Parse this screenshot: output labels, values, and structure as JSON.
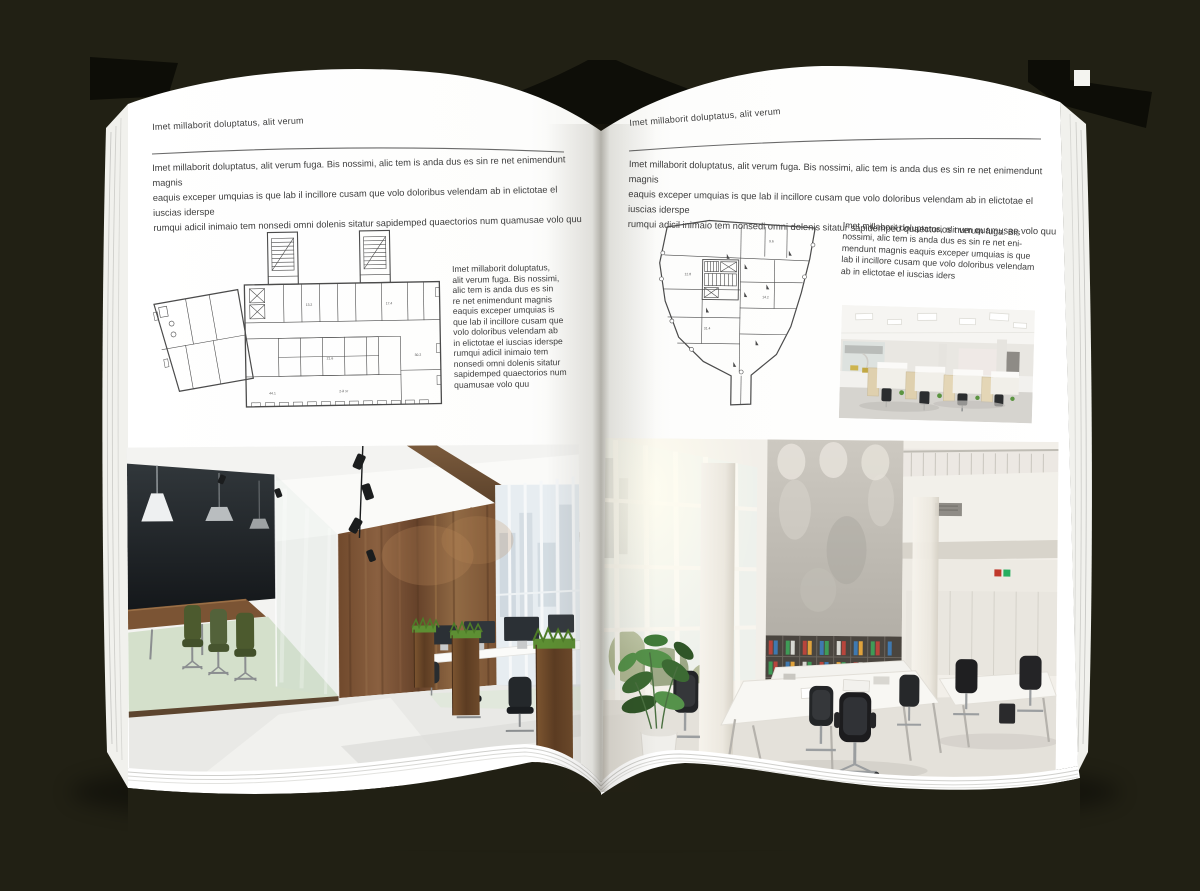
{
  "colors": {
    "background": "#212014",
    "cover": "#0d0d07",
    "page": "#ffffff",
    "page_edge_line": "#c8c8c5",
    "text": "#3e3e3e",
    "rule": "#6a6a6a",
    "plan_line": "#4b4b4b",
    "wood": "#7a5334",
    "grass_green": "#5d8f33",
    "chair_green": "#4f5e33",
    "meeting_floor_green": "#d4e0cb",
    "binder_red": "#b8453c",
    "binder_blue": "#3f79b0",
    "binder_green": "#3f9b57"
  },
  "left_page": {
    "kicker": "Imet millaborit doluptatus, alit verum",
    "intro_lines": [
      "Imet millaborit doluptatus, alit verum fuga. Bis nossimi, alic tem is anda dus es sin re net enimendunt magnis",
      "eaquis exceper umquias is que lab il incillore cusam que volo doloribus velendam ab in elictotae el iuscias iderspe",
      "rumqui adicil inimaio tem nonsedi omni dolenis sitatur sapidemped quaectorios num quamusae volo quu"
    ],
    "plan": {
      "floor_label": "2-й эт",
      "room_labels": [
        "13.2",
        "17.4",
        "21.6",
        "30.2",
        "44.1"
      ]
    },
    "caption_lines": [
      "Imet millaborit doluptatus,",
      "alit verum fuga. Bis nossimi,",
      "alic tem is anda dus es sin",
      "re net enimendunt magnis",
      "eaquis exceper umquias is",
      "que lab il incillore cusam que",
      "volo doloribus velendam ab",
      "in elictotae el iuscias iderspe",
      "rumqui adicil inimaio tem",
      "nonsedi omni dolenis sitatur",
      "sapidemped quaectorios num",
      "quamusae volo quu"
    ],
    "photo": "open-plan-office-with-glass-meeting-room"
  },
  "right_page": {
    "kicker": "Imet millaborit doluptatus, alit verum",
    "intro_lines": [
      "Imet millaborit doluptatus, alit verum fuga. Bis nossimi, alic tem is anda dus es sin re net enimendunt magnis",
      "eaquis exceper umquias is que lab il incillore cusam que volo doloribus velendam ab in elictotae el iuscias iderspe",
      "rumqui adicil inimaio tem nonsedi omni dolenis sitatur sapidemped quaectorios num quamusae volo quu"
    ],
    "plan": {
      "room_labels": [
        "12.8",
        "9.6",
        "31.4",
        "14.2"
      ]
    },
    "caption_lines": [
      "Imet millaborit doluptatus, alit verum fuga. Bis",
      "nossimi, alic tem is anda dus es sin re net eni-",
      "mendunt magnis eaquis exceper umquias is que",
      "lab il incillore cusam que volo doloribus velendam",
      "ab in elictotae el iuscias iders"
    ],
    "photo_small": "cubicle-office-interior",
    "photo": "bright-atrium-office-interior"
  }
}
